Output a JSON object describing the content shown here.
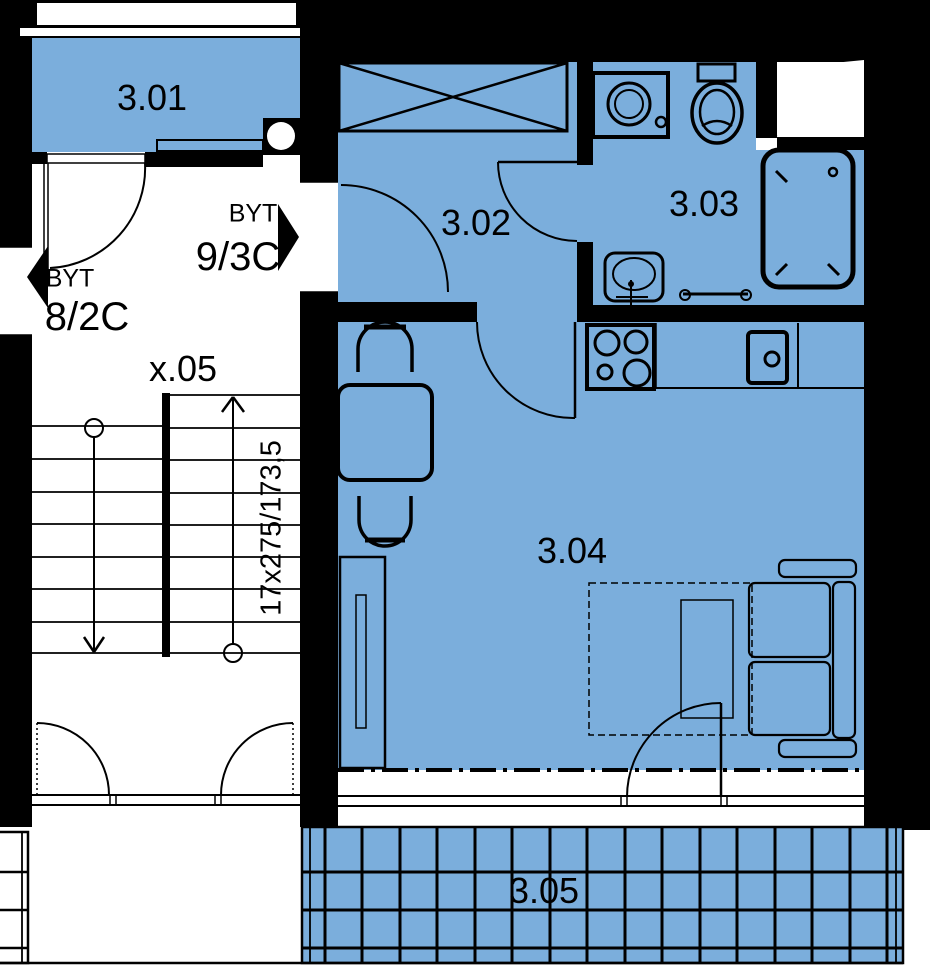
{
  "colors": {
    "room_fill": "#7baedc",
    "line": "#000000",
    "paper": "#ffffff"
  },
  "rooms": {
    "r301": {
      "label": "3.01"
    },
    "r302": {
      "label": "3.02"
    },
    "r303": {
      "label": "3.03"
    },
    "r304": {
      "label": "3.04"
    },
    "r305": {
      "label": "3.05"
    }
  },
  "stairwell": {
    "label": "x.05",
    "dimension": "17x275/173,5"
  },
  "apartments": {
    "byt_9_3c": {
      "prefix": "BYT",
      "number": "9/3C"
    },
    "byt_8_2c": {
      "prefix": "BYT",
      "number": "8/2C"
    }
  },
  "fixtures": [
    "wardrobe-x-box",
    "washing-machine",
    "toilet",
    "bathtub",
    "bathroom-sink",
    "towel-rail",
    "stove",
    "kitchen-sink",
    "kitchen-counter",
    "dining-table",
    "chair",
    "tall-cabinet",
    "bed-dashed",
    "sofa",
    "door-swing",
    "double-entry-door",
    "stairs-up-down",
    "balcony-tile-grid"
  ]
}
